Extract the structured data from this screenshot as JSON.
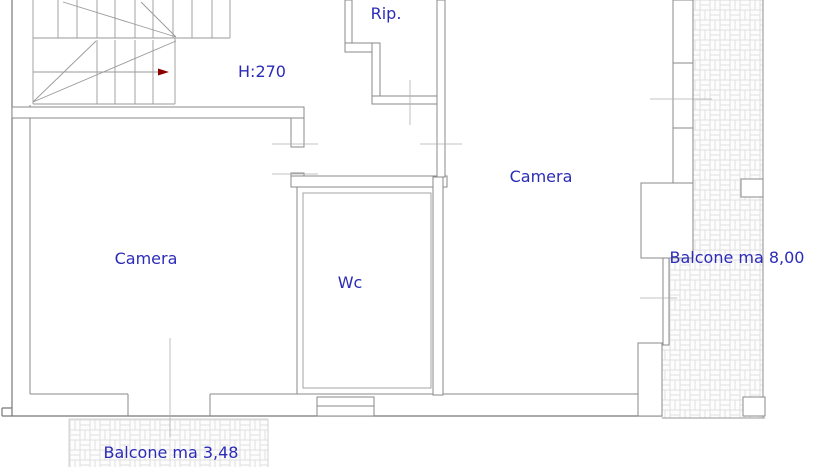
{
  "plan": {
    "type": "floor-plan",
    "labels": {
      "storage": "Rip.",
      "ceiling_height": "H:270",
      "bedroom_right": "Camera",
      "bedroom_left": "Camera",
      "bathroom": "Wc",
      "balcony_right": "Balcone ma 8,00",
      "balcony_bottom": "Balcone ma 3,48"
    },
    "colors": {
      "background": "#ffffff",
      "label_text": "#2b2bb8",
      "wall_line": "#8a8a8a",
      "thin_tick": "#b0b0b0",
      "hatch_line": "#e0e0e0",
      "stair_arrow": "#8b0000"
    }
  }
}
